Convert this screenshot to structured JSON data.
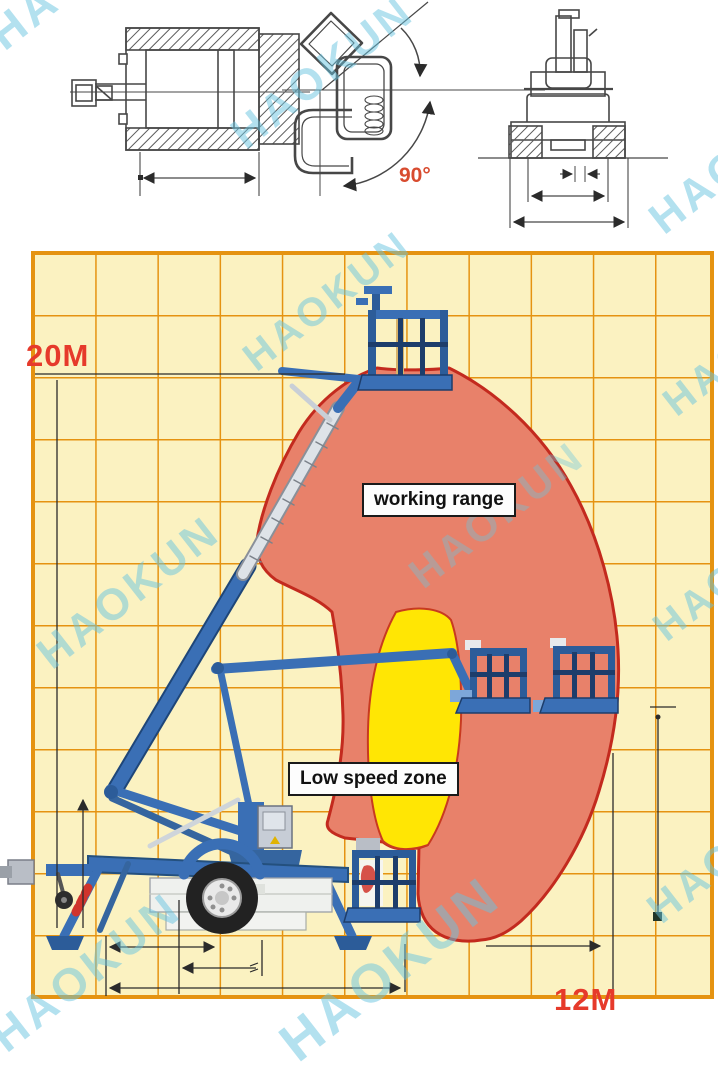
{
  "diagram": {
    "watermark_text": "HAOKUN",
    "labels": {
      "max_height": "20M",
      "max_reach": "12M",
      "rotation_angle": "90°",
      "working_range": "working range",
      "low_speed_zone": "Low speed zone"
    },
    "colors": {
      "grid_background": "#FBF2C1",
      "grid_line": "#E59311",
      "working_range_fill": "#E8816A",
      "working_range_outline": "#C32A1E",
      "low_speed_fill": "#FFE604",
      "machine_blue": "#3A6FB5",
      "dimension_red": "#E63A2B",
      "watermark_cyan": "#6EC4DE"
    },
    "drawings": [
      "plan view",
      "platform rotation 90°",
      "rear view",
      "working range chart"
    ]
  }
}
